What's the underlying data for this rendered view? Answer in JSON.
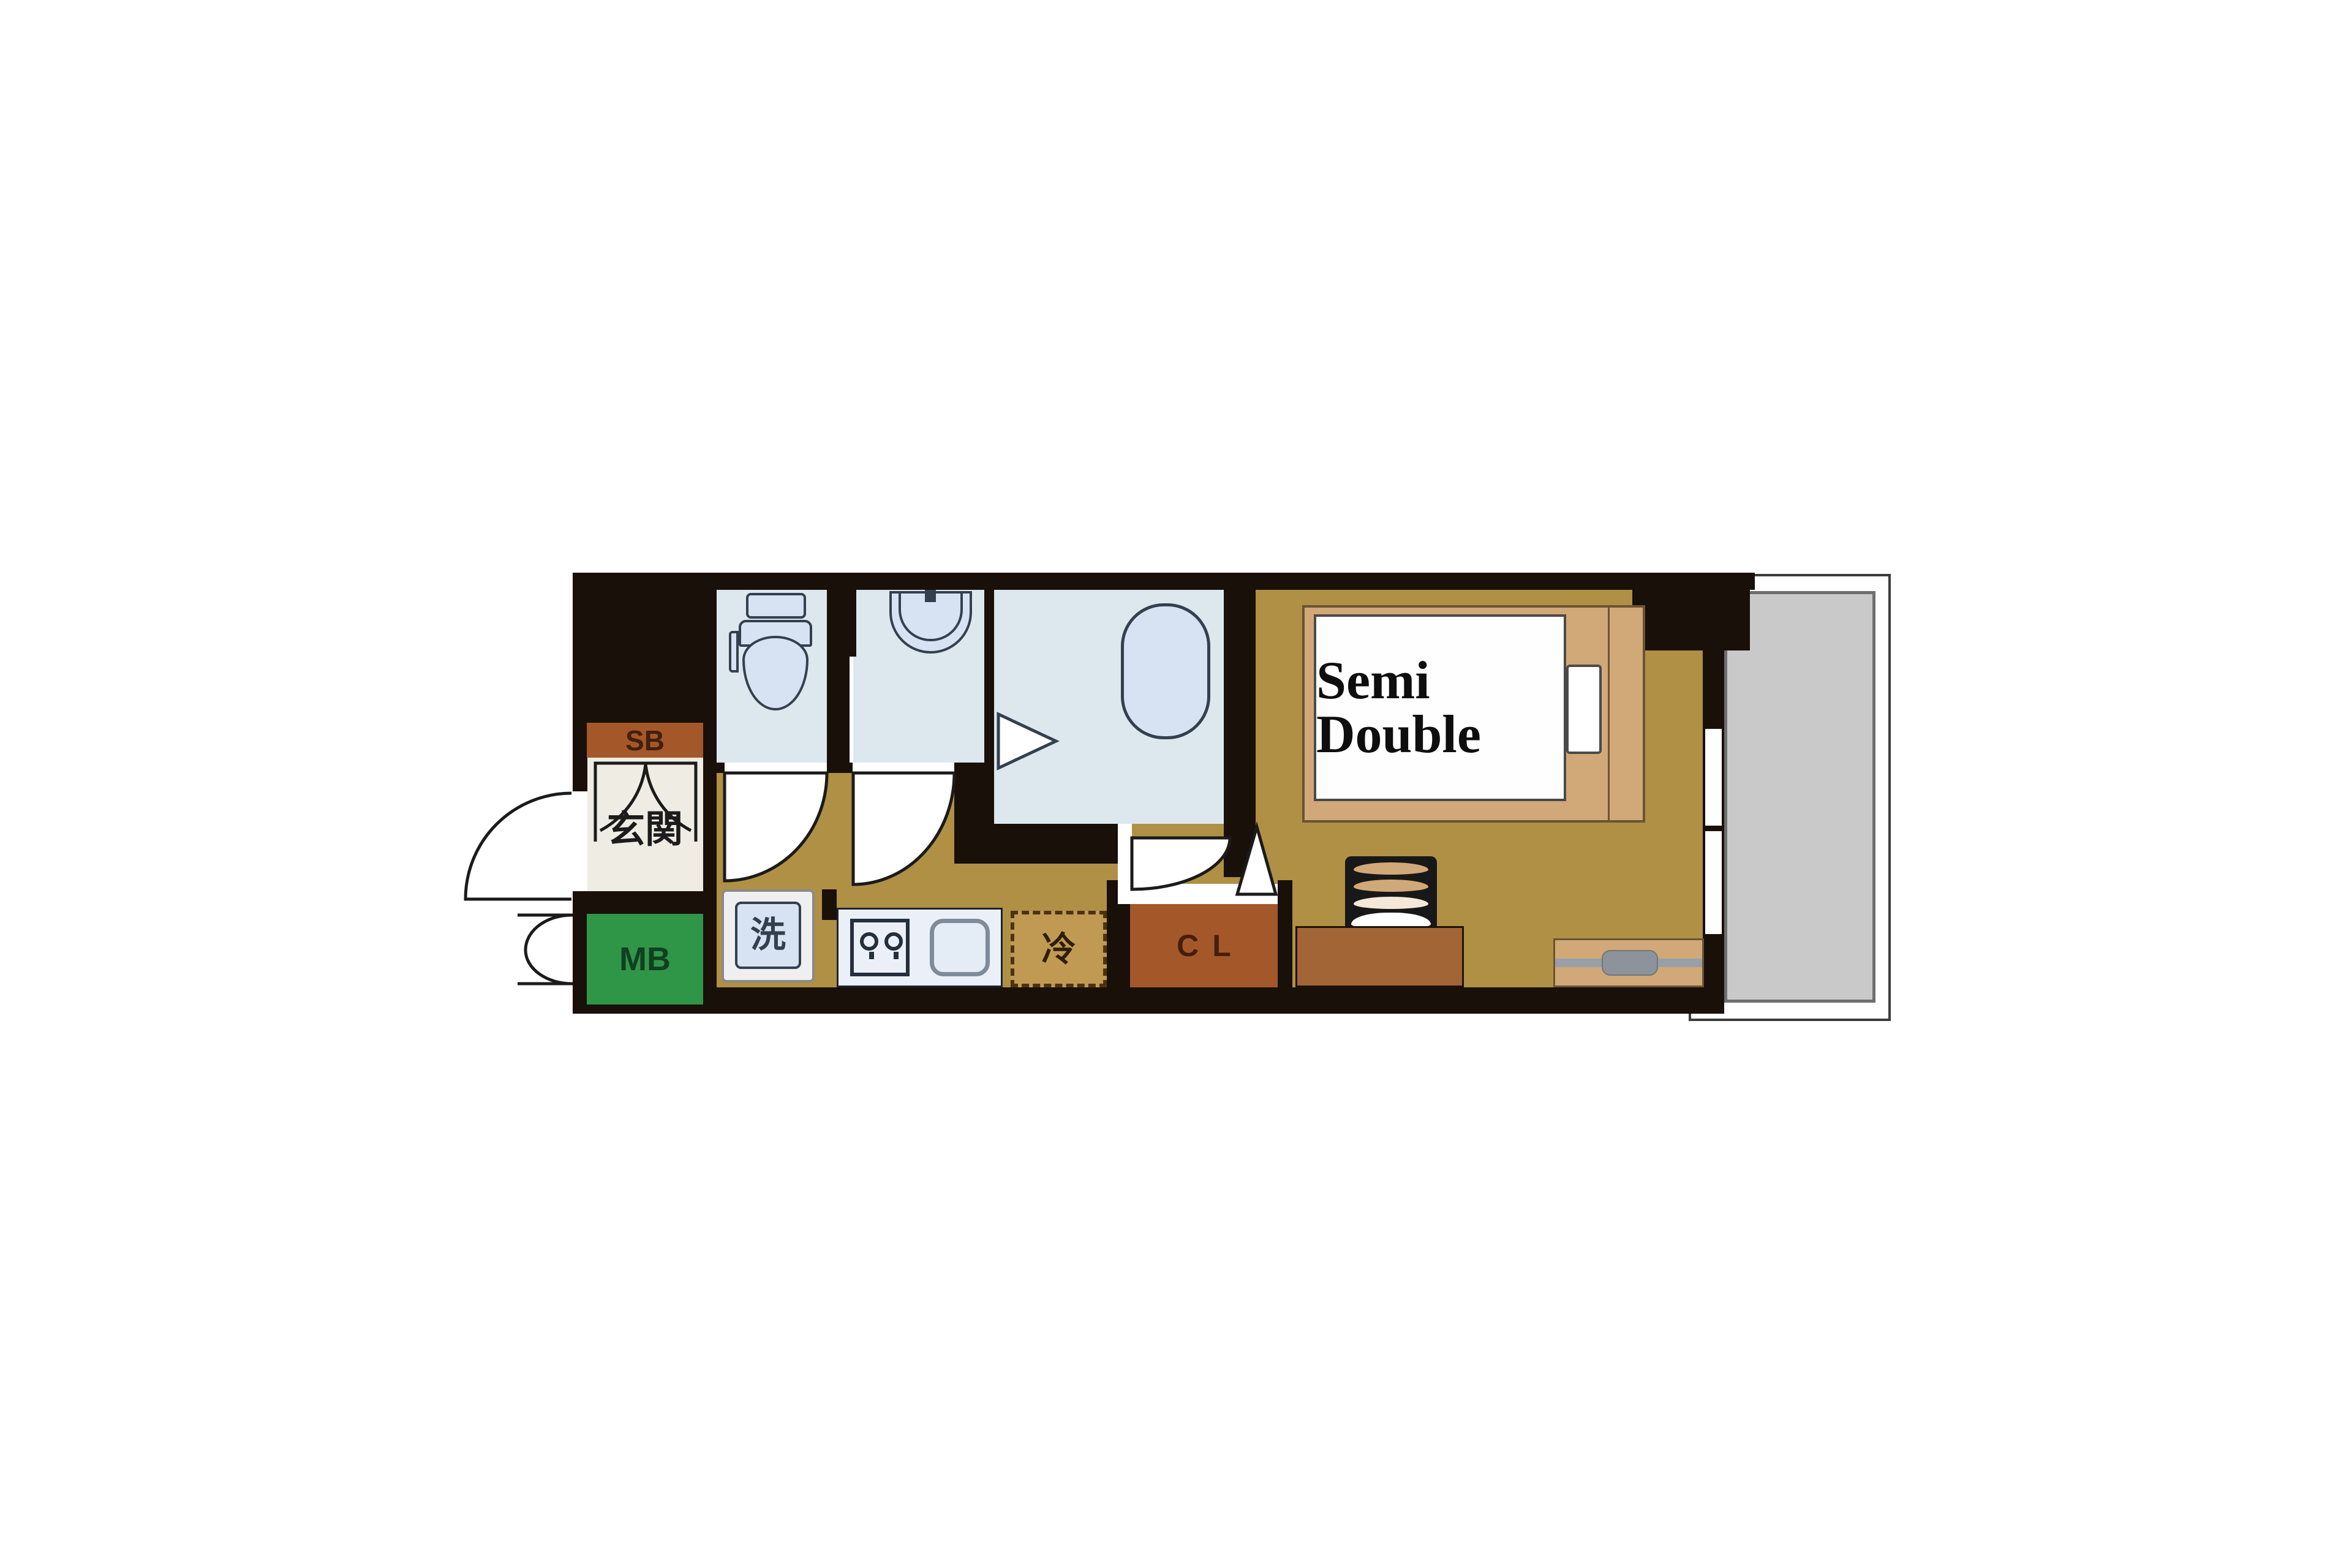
{
  "title": "1K apartment floor plan",
  "labels": {
    "shoe_box": "SB",
    "entrance": "玄関",
    "meter_box": "MB",
    "washing_machine": "洗",
    "refrigerator": "冷",
    "closet": "CL",
    "bed": "Semi Double"
  },
  "colors": {
    "bg": "#ffffff",
    "wall": "#191009",
    "floor-tan": "#b09045",
    "floor-cream": "#efece4",
    "room-blue": "#dde7ee",
    "fixture-blue": "#d7e3f3",
    "fixture-line": "#33404e",
    "counter-white": "#ebf0f8",
    "brown-box": "#a4582a",
    "brown-text": "#42200c",
    "green-box": "#2f9648",
    "green-text": "#123f20",
    "bed-frame": "#d1a878",
    "bed-frame-line": "#6b5334",
    "fridge-fill": "#c09a52",
    "fridge-line": "#4a3310",
    "balcony-gray": "#c9c9c9",
    "balcony-line": "#6e6e6e",
    "balcony-outer-line": "#3c3c3c",
    "line": "#1b1b1b",
    "desk-brown": "#a26636",
    "tv-gray": "#8d939b",
    "text-dark": "#1c1c1c"
  }
}
